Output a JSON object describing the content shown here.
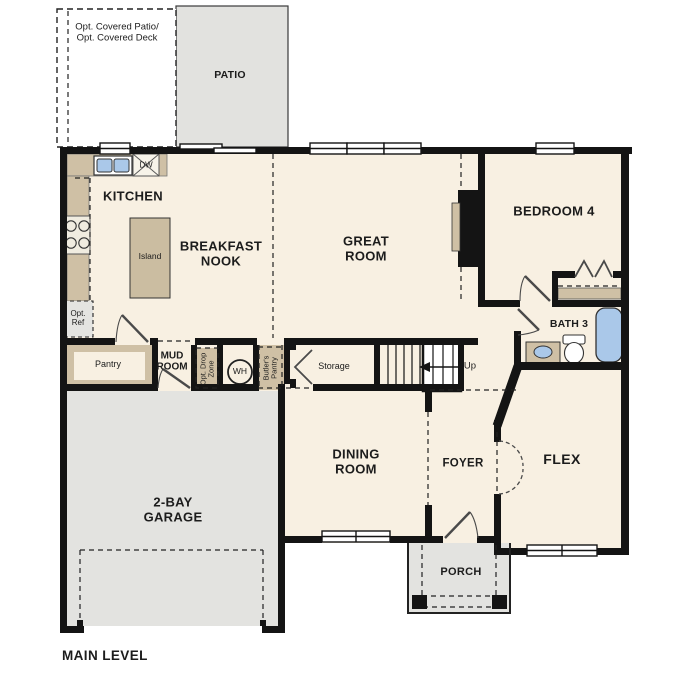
{
  "plan_title": "MAIN LEVEL",
  "outdoor": {
    "opt_covered": "Opt. Covered Patio/\nOpt. Covered Deck",
    "patio": "PATIO",
    "porch": "PORCH"
  },
  "rooms": {
    "kitchen": "KITCHEN",
    "breakfast_nook": "BREAKFAST\nNOOK",
    "great_room": "GREAT\nROOM",
    "bedroom4": "BEDROOM 4",
    "bath3": "BATH 3",
    "dining_room": "DINING\nROOM",
    "foyer": "FOYER",
    "flex": "FLEX",
    "garage": "2-BAY\nGARAGE",
    "mud_room": "MUD\nROOM"
  },
  "features": {
    "island": "Island",
    "pantry": "Pantry",
    "storage": "Storage",
    "up": "Up",
    "dishwasher": "DW",
    "water_heater": "WH",
    "opt_ref": "Opt.\nRef",
    "opt_drop_zone": "Opt. Drop\nZone",
    "butlers_pantry": "Butler's\nPantry"
  },
  "colors": {
    "wall": "#141414",
    "floor": "#f8f0e2",
    "counter": "#cfc0a5",
    "concrete": "#e3e3e0",
    "fixture_blue": "#aac8e9"
  }
}
